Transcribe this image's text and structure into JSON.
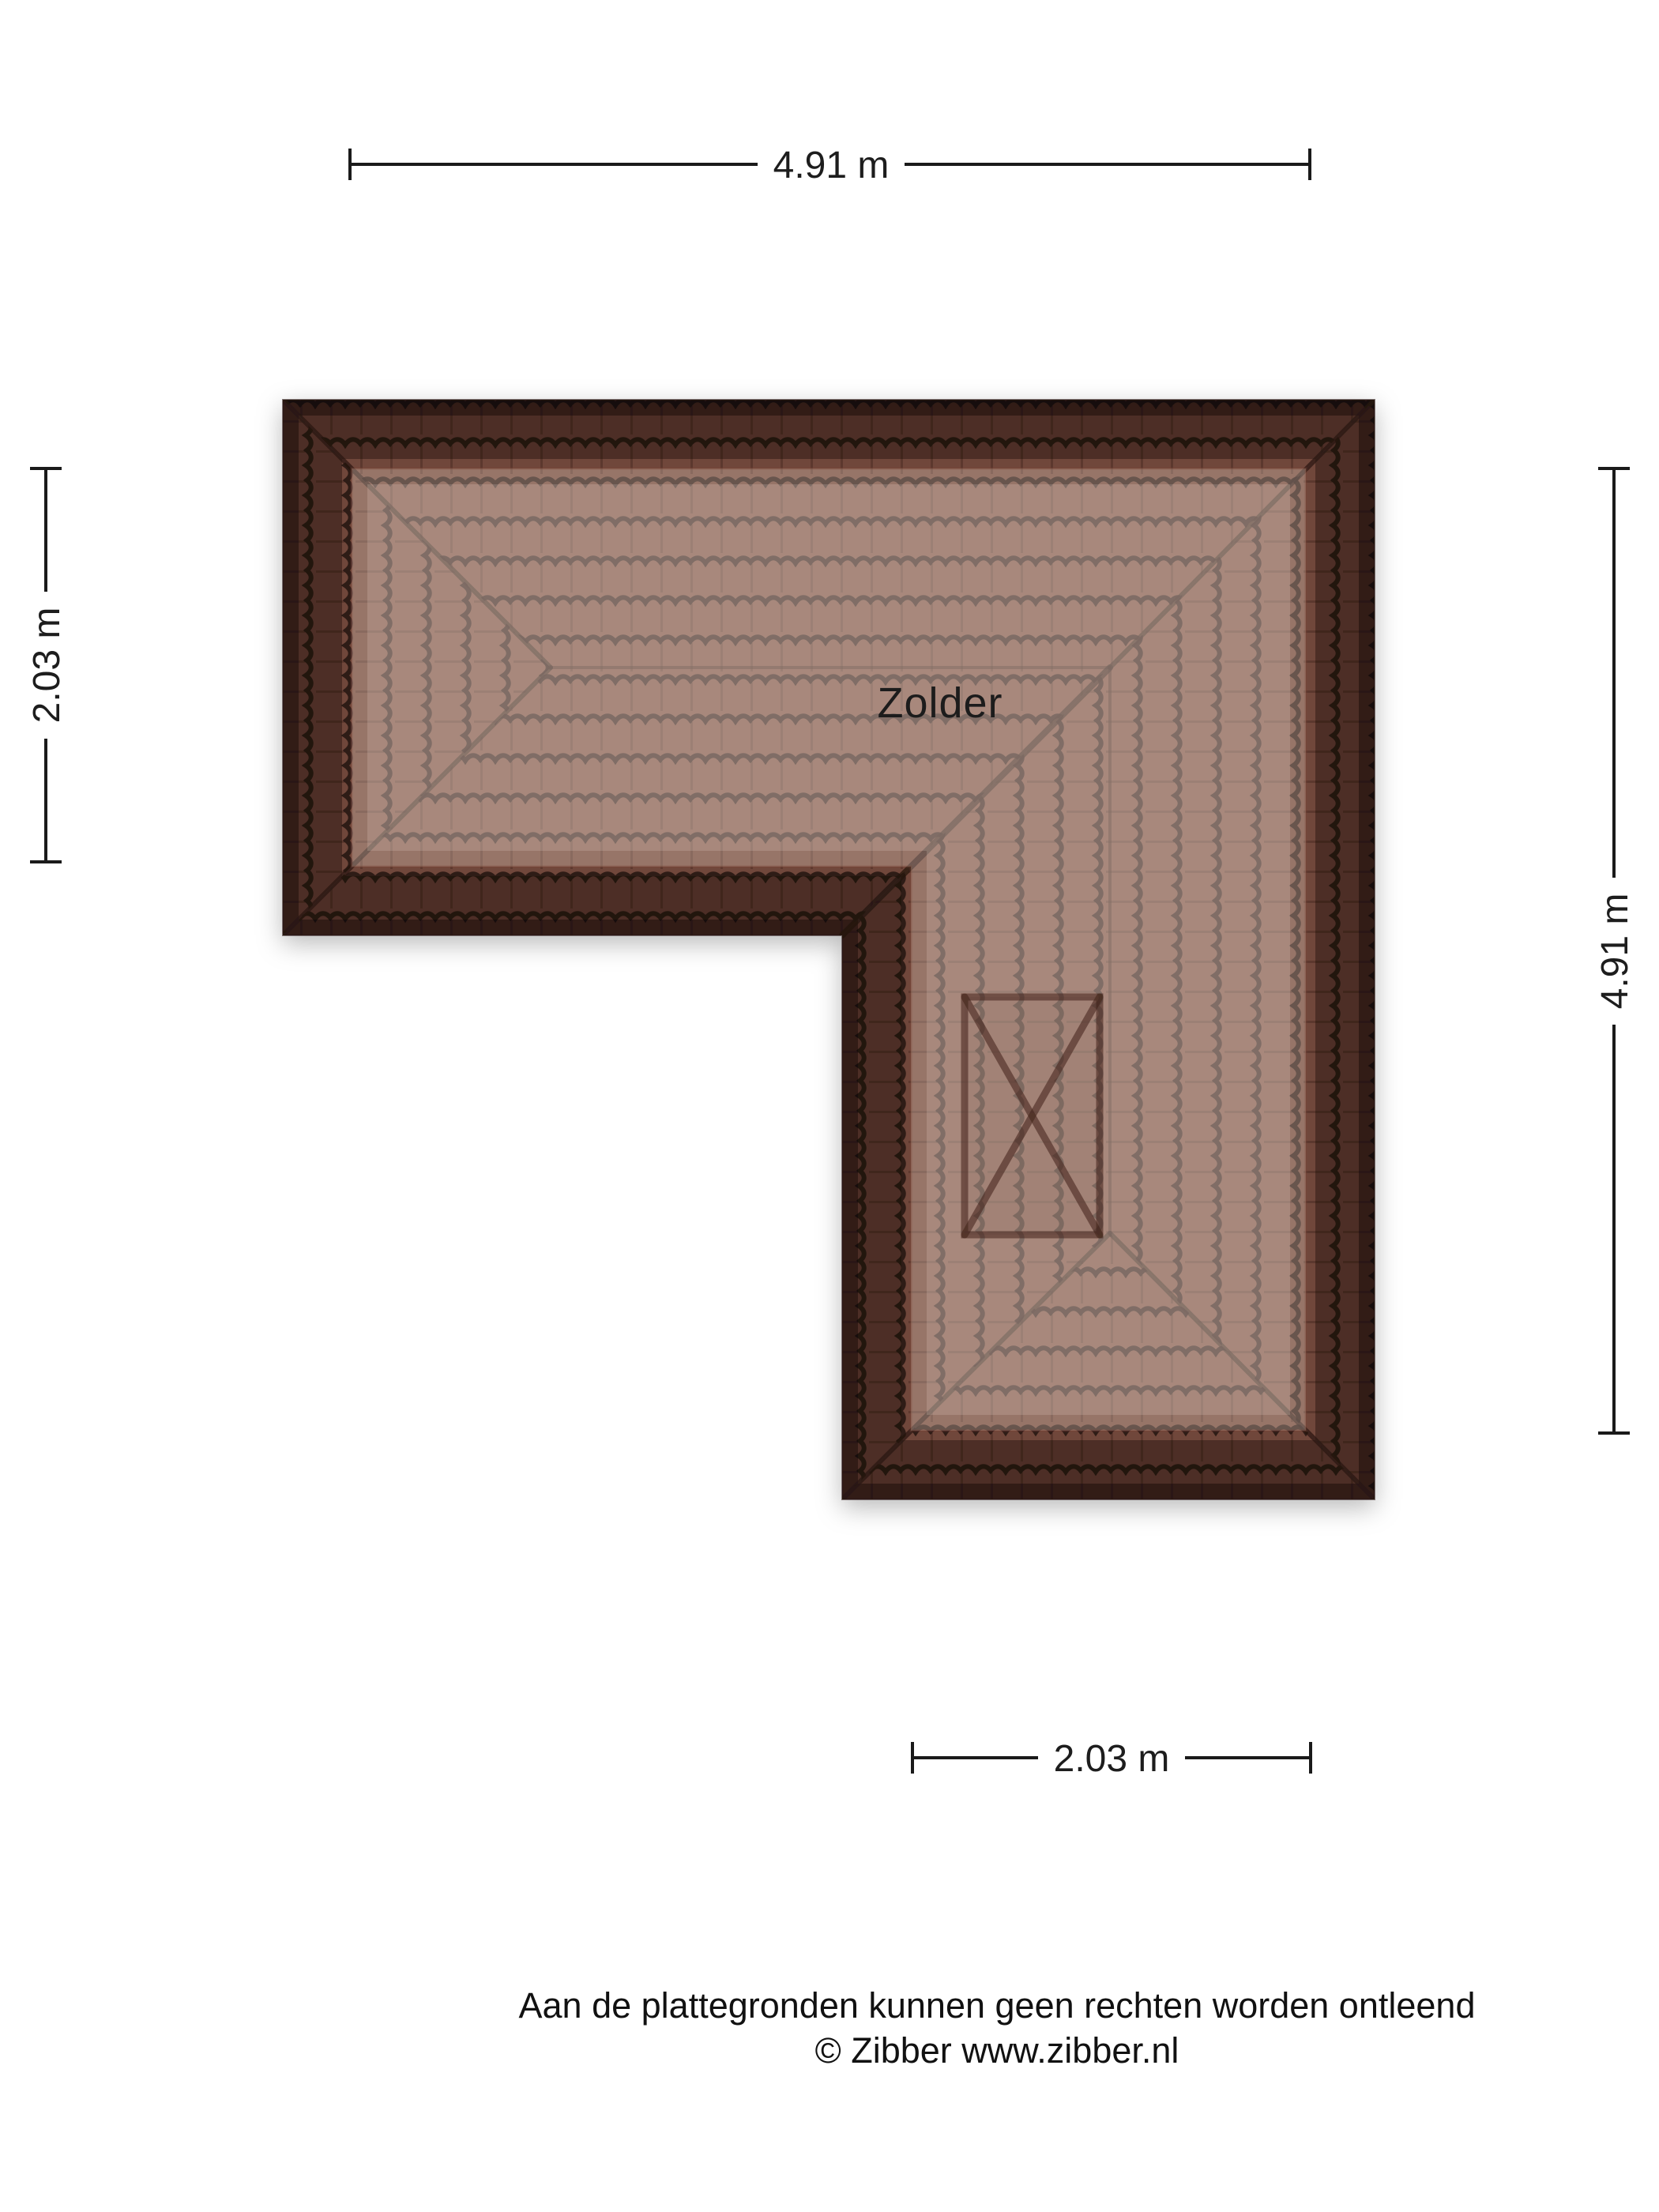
{
  "plan": {
    "room_label": "Zolder",
    "dimensions": {
      "top": "4.91 m",
      "left": "2.03 m",
      "right": "4.91 m",
      "bottom": "2.03 m"
    },
    "colors": {
      "tile_base": "#70463a",
      "tile_row_line": "#26150f",
      "tile_col_line": "#4a2c22",
      "hip_line": "#26150f",
      "rim_shade": "rgba(20,10,7,0.38)",
      "rim_edge": "rgba(12,6,4,0.42)",
      "overlay_light": "rgba(255,236,228,0.28)",
      "overlay_inner": "rgba(255,236,228,0.17)",
      "overlay_edge": "rgba(120,70,55,0.35)",
      "window_frame": "rgba(63,33,24,0.55)",
      "dim_line": "#1a1a1a"
    }
  },
  "footer": {
    "line1": "Aan de plattegronden kunnen geen rechten worden ontleend",
    "line2": "© Zibber www.zibber.nl"
  }
}
